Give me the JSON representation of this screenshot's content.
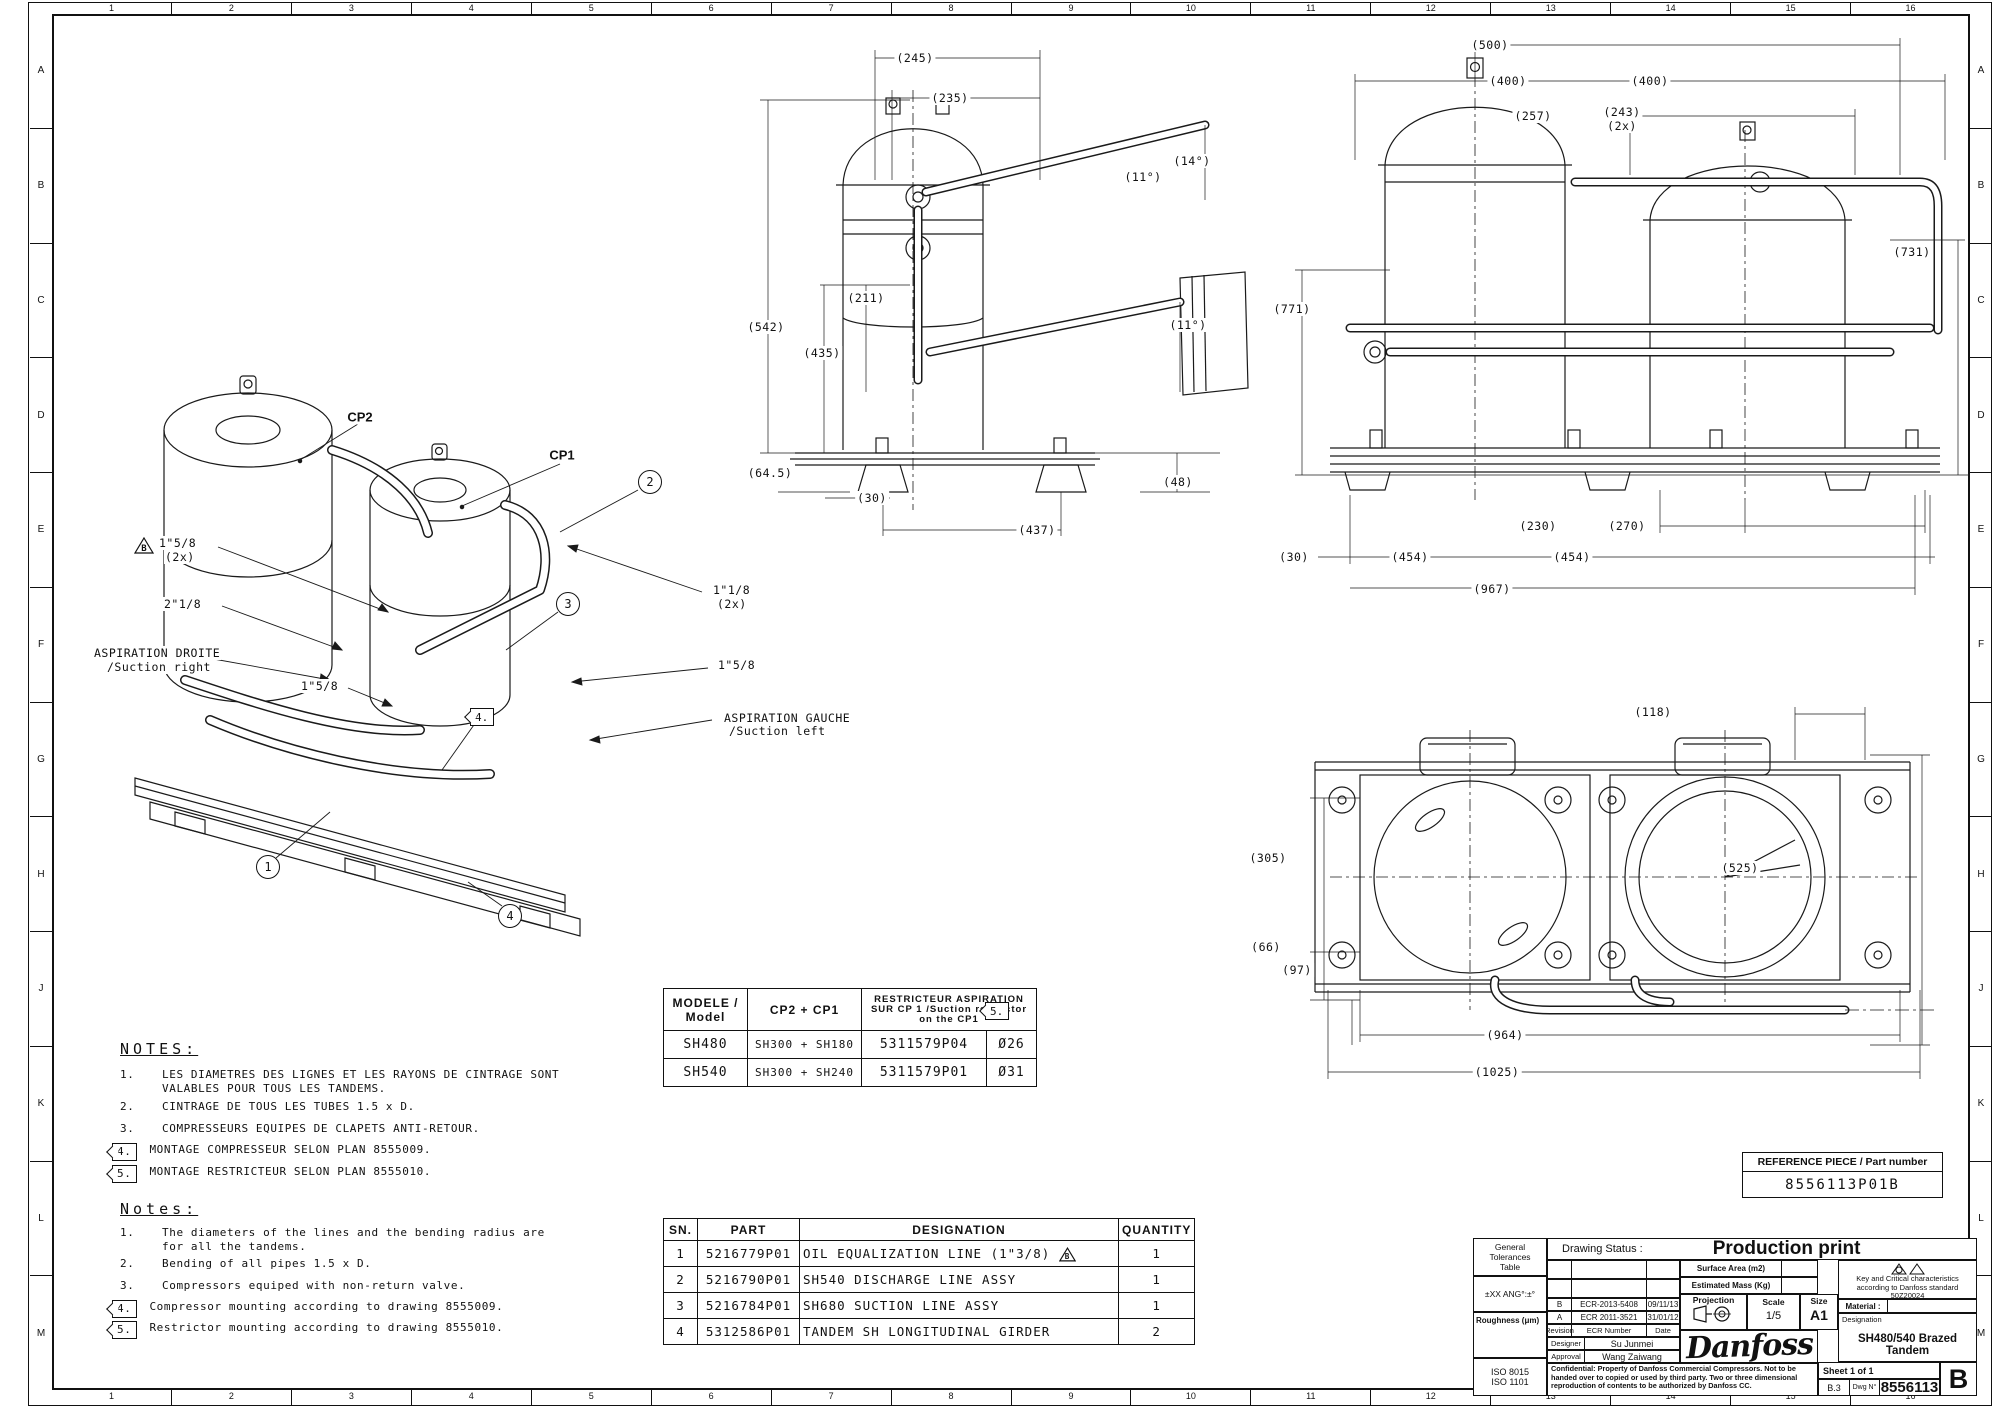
{
  "sheet": {
    "cols": [
      "1",
      "2",
      "3",
      "4",
      "5",
      "6",
      "7",
      "8",
      "9",
      "10",
      "11",
      "12",
      "13",
      "14",
      "15",
      "16"
    ],
    "rows": [
      "A",
      "B",
      "C",
      "D",
      "E",
      "F",
      "G",
      "H",
      "J",
      "K",
      "L",
      "M"
    ]
  },
  "iso_view": {
    "cp2": "CP2",
    "cp1": "CP1",
    "flag_b": "B",
    "labels": {
      "d1": "1\"5/8",
      "d1b": "(2x)",
      "d2": "2\"1/8",
      "suction_right_fr": "ASPIRATION DROITE",
      "suction_right_en": "/Suction right",
      "d3": "1\"5/8",
      "d4": "1\"1/8",
      "d4b": "(2x)",
      "d5": "1\"5/8",
      "suction_left_fr": "ASPIRATION GAUCHE",
      "suction_left_en": "/Suction left"
    },
    "balloons": [
      "1",
      "2",
      "3",
      "4"
    ],
    "flag4": "4."
  },
  "front_view": {
    "dims": [
      "(245)",
      "(235)",
      "(14°)",
      "(11°)",
      "(211)",
      "(542)",
      "(435)",
      "(11°)",
      "(64.5)",
      "(30)",
      "(437)",
      "(48)"
    ]
  },
  "side_view": {
    "dims": [
      "(500)",
      "(400)",
      "(400)",
      "(257)",
      "(243)",
      "(2x)",
      "(771)",
      "(731)",
      "(230)",
      "(270)",
      "(30)",
      "(454)",
      "(454)",
      "(967)"
    ]
  },
  "plan_view": {
    "dims": [
      "(118)",
      "(525)",
      "(305)",
      "(66)",
      "(97)",
      "(964)",
      "(1025)"
    ]
  },
  "model_table": {
    "header_model": "MODELE / Model",
    "header_cp": "CP2 + CP1",
    "header_restrictor": "RESTRICTEUR ASPIRATION SUR CP 1 /Suction restrictor on the CP1",
    "flag": "5.",
    "rows": [
      {
        "model": "SH480",
        "cp": "SH300 + SH180",
        "part": "5311579P04",
        "dia": "Ø26"
      },
      {
        "model": "SH540",
        "cp": "SH300 + SH240",
        "part": "5311579P01",
        "dia": "Ø31"
      }
    ]
  },
  "notes_fr": {
    "title": "NOTES:",
    "items": [
      {
        "num": "1.",
        "text": "LES DIAMETRES DES LIGNES ET LES RAYONS DE CINTRAGE SONT VALABLES POUR TOUS LES TANDEMS."
      },
      {
        "num": "2.",
        "text": "CINTRAGE DE TOUS LES TUBES 1.5 x D."
      },
      {
        "num": "3.",
        "text": "COMPRESSEURS EQUIPES DE CLAPETS ANTI-RETOUR."
      },
      {
        "num": "4.",
        "text": "MONTAGE COMPRESSEUR SELON PLAN 8555009."
      },
      {
        "num": "5.",
        "text": "MONTAGE RESTRICTEUR SELON PLAN 8555010."
      }
    ]
  },
  "notes_en": {
    "title": "Notes:",
    "items": [
      {
        "num": "1.",
        "text": "The diameters of the lines and the bending radius are for all the tandems."
      },
      {
        "num": "2.",
        "text": "Bending of all pipes 1.5 x D."
      },
      {
        "num": "3.",
        "text": "Compressors equiped with non-return valve."
      },
      {
        "num": "4.",
        "text": "Compressor mounting according to drawing 8555009."
      },
      {
        "num": "5.",
        "text": "Restrictor mounting according to drawing 8555010."
      }
    ]
  },
  "parts_table": {
    "headers": [
      "SN.",
      "PART",
      "DESIGNATION",
      "QUANTITY"
    ],
    "marker": "B",
    "rows": [
      {
        "sn": "1",
        "part": "5216779P01",
        "designation": "OIL EQUALIZATION LINE (1\"3/8)",
        "qty": "1"
      },
      {
        "sn": "2",
        "part": "5216790P01",
        "designation": "SH540 DISCHARGE LINE ASSY",
        "qty": "1"
      },
      {
        "sn": "3",
        "part": "5216784P01",
        "designation": "SH680 SUCTION LINE ASSY",
        "qty": "1"
      },
      {
        "sn": "4",
        "part": "5312586P01",
        "designation": "TANDEM SH LONGITUDINAL GIRDER",
        "qty": "2"
      }
    ]
  },
  "reference": {
    "label": "REFERENCE PIECE / Part number",
    "value": "8556113P01B"
  },
  "title_block": {
    "general_tolerances": "General Tolerances Table",
    "tolerance_note": "±XX  ANG°:±°",
    "roughness": "Roughness (μm)",
    "iso1": "ISO 8015",
    "iso2": "ISO 1101",
    "drawing_status_label": "Drawing Status :",
    "drawing_status": "Production print",
    "surface_area_label": "Surface Area (m2)",
    "estimated_mass_label": "Estimated Mass (Kg)",
    "projection_label": "Projection",
    "scale_label": "Scale",
    "scale_value": "1/5",
    "size_label": "Size",
    "size_value": "A1",
    "revisions": [
      {
        "rev": "B",
        "ecr": "ECR-2013-5408",
        "date": "09/11/13"
      },
      {
        "rev": "A",
        "ecr": "ECR 2011-3521",
        "date": "31/01/12"
      }
    ],
    "rev_header": {
      "rev": "Revision",
      "ecr": "ECR Number",
      "date": "Date"
    },
    "designer_label": "Designer",
    "designer": "Su Junmei",
    "approval_label": "Approval",
    "approval": "Wang Zaiwang",
    "confidential": "Confidential: Property of Danfoss Commercial Compressors. Not to be handed over to copied or used by third party. Two or three dimensional reproduction of contents to be authorized by Danfoss CC.",
    "key_critical": "Key and Critical characteristics according to Danfoss standard 50Z20024",
    "material_label": "Material :",
    "designation_label": "Designation",
    "designation": "SH480/540 Brazed Tandem",
    "sheet_label": "Sheet 1 of 1",
    "frame_ref": "B.3",
    "dwg_label": "Dwg N°",
    "dwg_number": "8556113",
    "revision_letter": "B",
    "logo": "Danfoss"
  }
}
